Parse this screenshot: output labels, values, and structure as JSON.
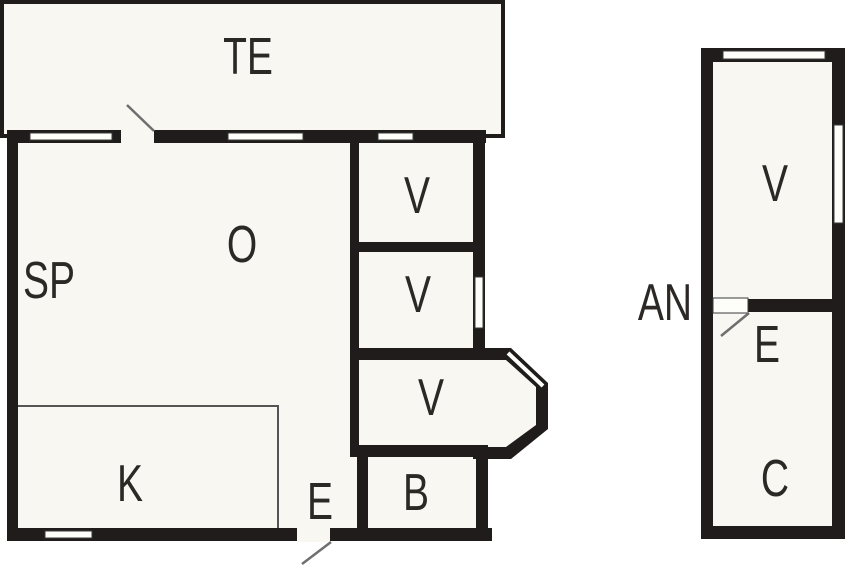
{
  "plan": {
    "type": "floor-plan",
    "main_building": {
      "terrace": "TE",
      "bedroom_sp": "SP",
      "living_room": "O",
      "kitchen": "K",
      "entry": "E",
      "bathroom": "B",
      "bedroom_v1": "V",
      "bedroom_v2": "V",
      "bedroom_v3": "V"
    },
    "annex": {
      "name": "AN",
      "room_v": "V",
      "entry": "E",
      "room_c": "C"
    },
    "colors": {
      "wall": "#201c1b",
      "floor": "#f8f7f1",
      "background": "#ffffff",
      "thin_line": "#555555",
      "door_swing": "#6f6f6f",
      "label": "#2b2826"
    }
  }
}
